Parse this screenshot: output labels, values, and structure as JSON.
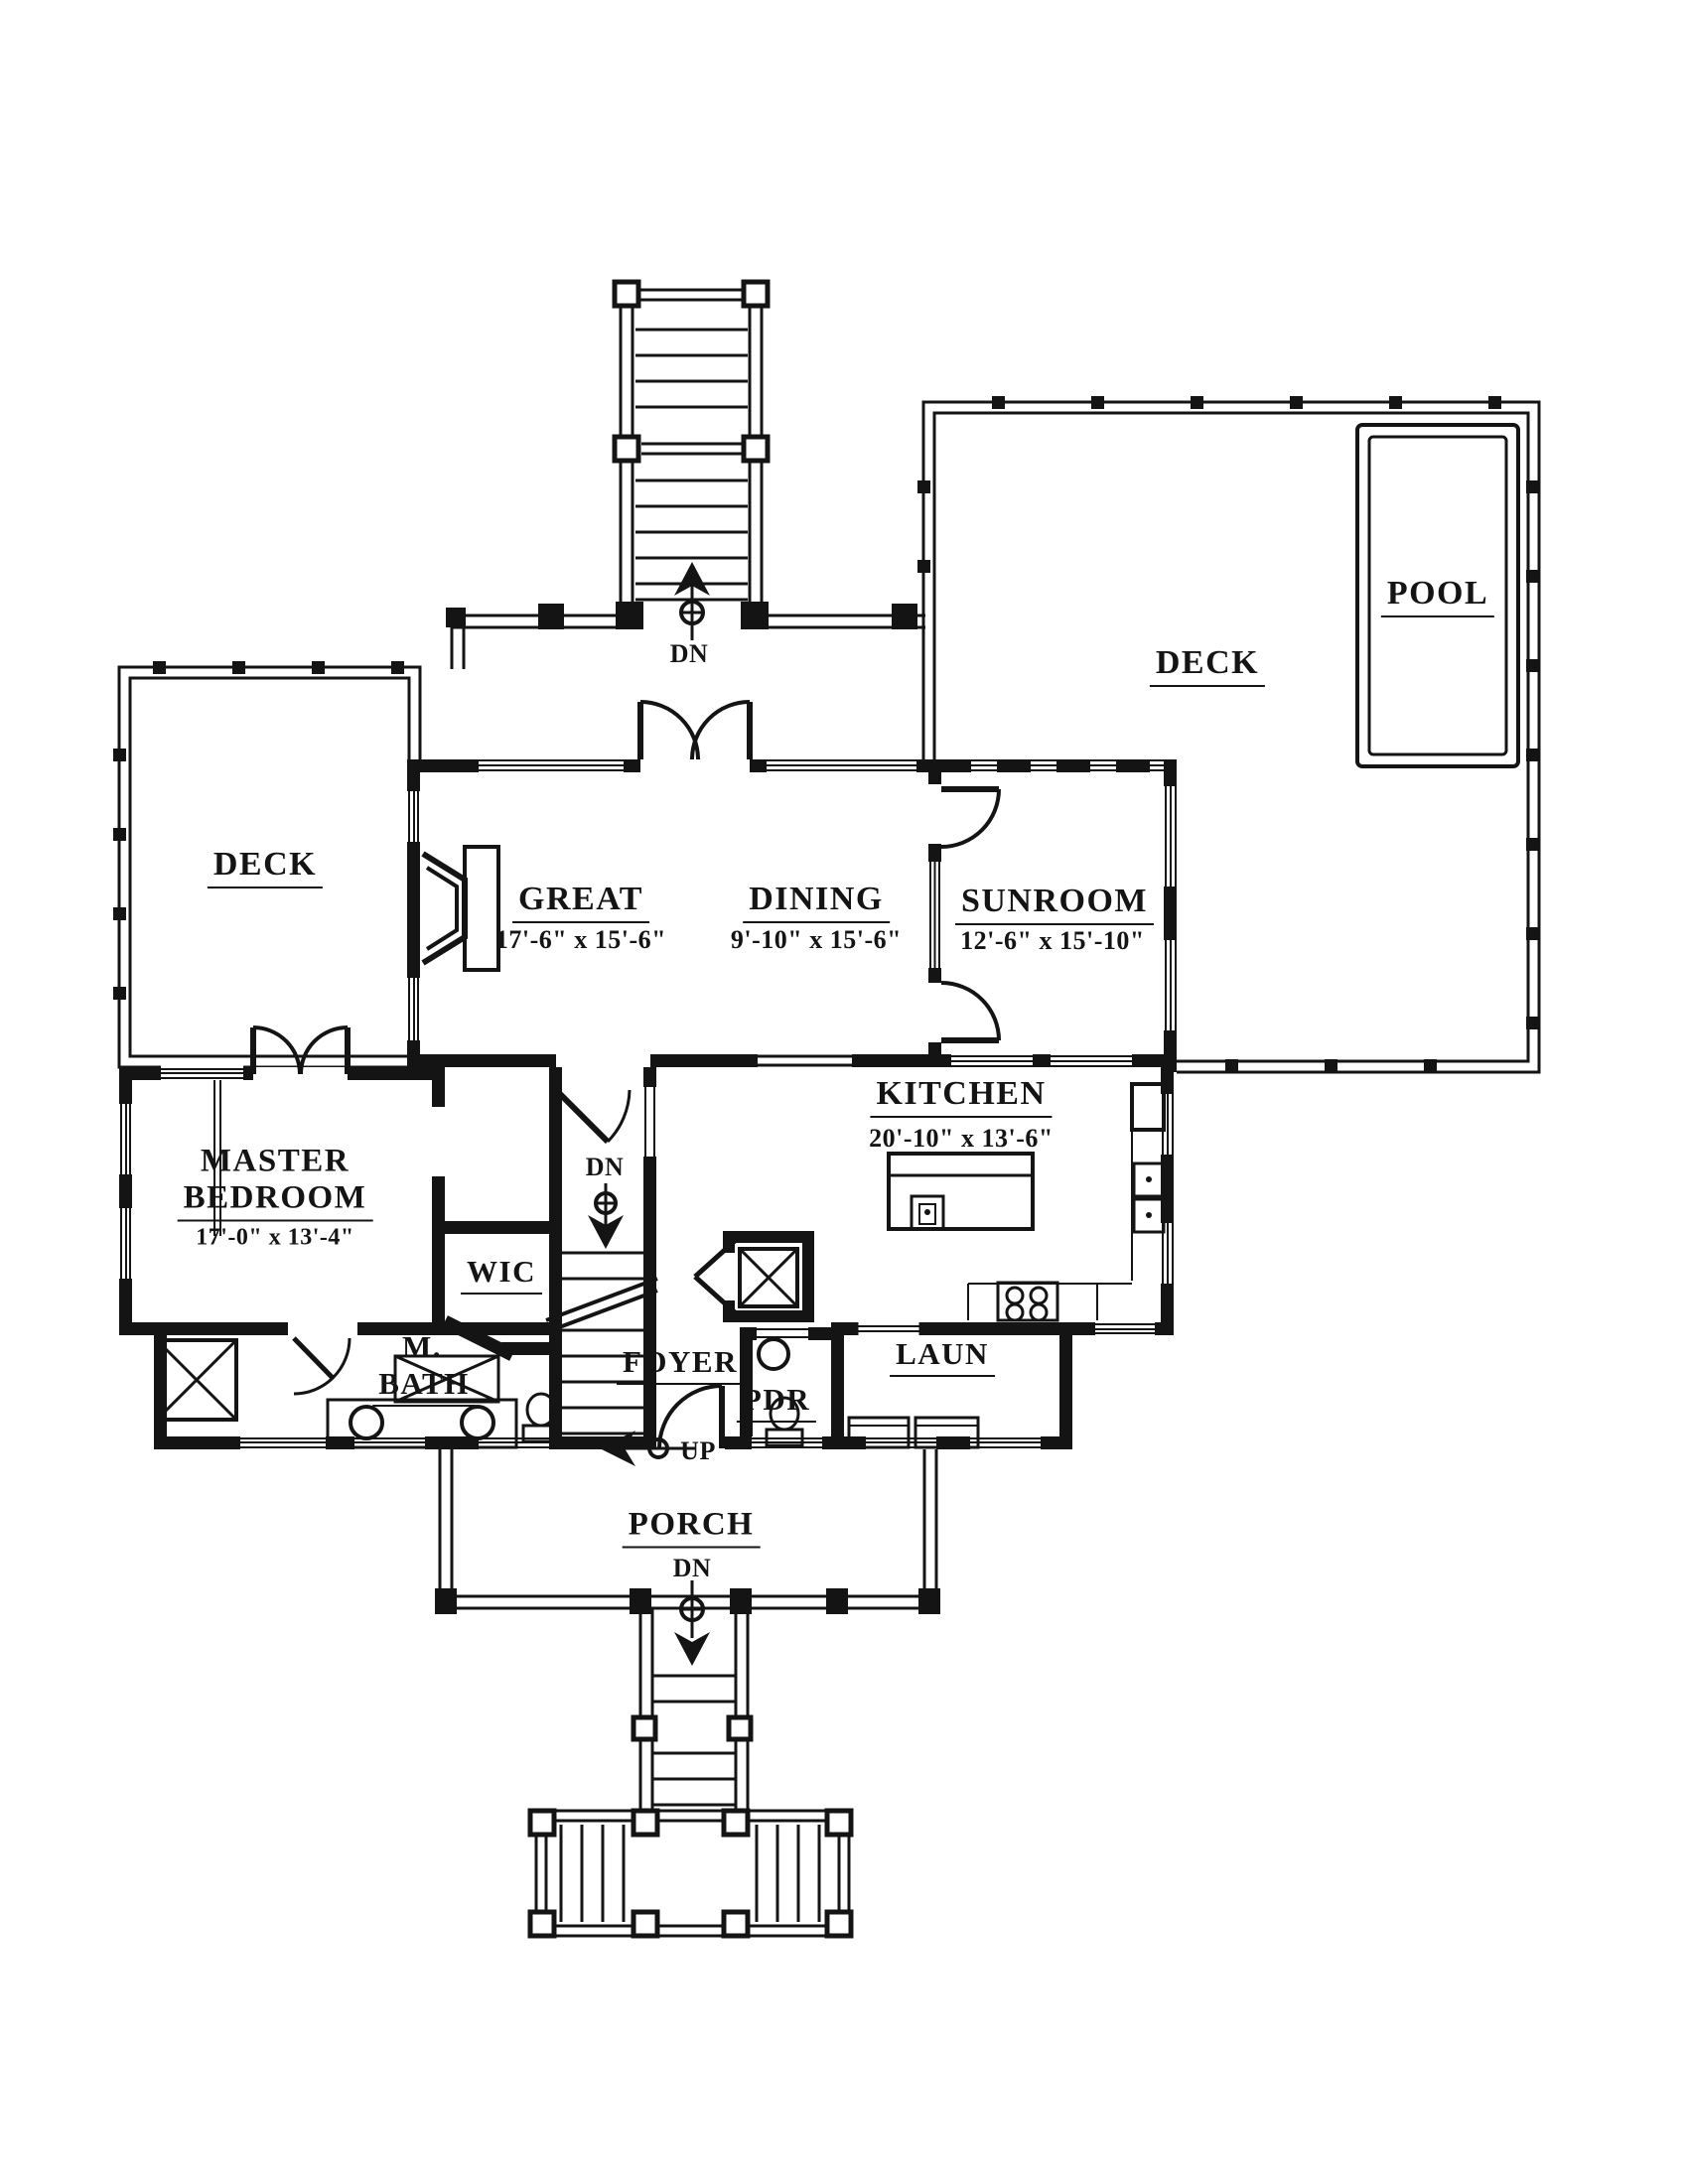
{
  "title": "House floor plan",
  "colors": {
    "ink": "#141414",
    "paper": "#ffffff"
  },
  "rooms": {
    "pool": {
      "label": "POOL"
    },
    "deck_right": {
      "label": "DECK"
    },
    "deck_left": {
      "label": "DECK"
    },
    "great": {
      "label": "GREAT",
      "dims": "17'-6\" x 15'-6\""
    },
    "dining": {
      "label": "DINING",
      "dims": "9'-10\" x 15'-6\""
    },
    "sunroom": {
      "label": "SUNROOM",
      "dims": "12'-6\" x 15'-10\""
    },
    "kitchen": {
      "label": "KITCHEN",
      "dims": "20'-10\" x 13'-6\""
    },
    "master_bedroom": {
      "line1": "MASTER",
      "line2": "BEDROOM",
      "dims": "17'-0\" x 13'-4\""
    },
    "wic": {
      "label": "WIC"
    },
    "master_bath": {
      "line1": "M.",
      "line2": "BATH"
    },
    "foyer": {
      "label": "FOYER"
    },
    "powder": {
      "label": "PDR"
    },
    "laundry": {
      "label": "LAUN"
    },
    "porch": {
      "label": "PORCH"
    }
  },
  "annotations": {
    "down_top": "DN",
    "down_interior": "DN",
    "down_porch": "DN",
    "up_foyer": "UP"
  }
}
